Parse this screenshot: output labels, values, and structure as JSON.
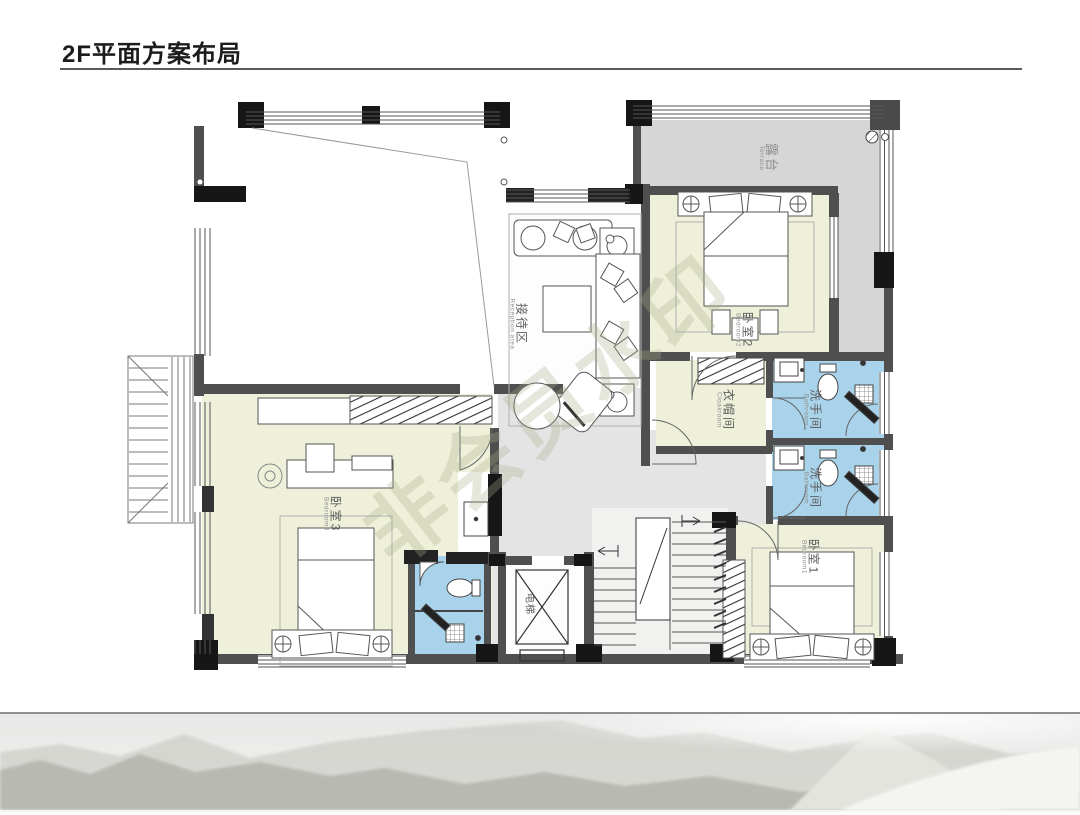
{
  "page": {
    "title": "2F平面方案布局",
    "watermark": "非会员水印"
  },
  "rooms": {
    "terrace": {
      "zh": "露台",
      "en": "Terrace"
    },
    "reception": {
      "zh": "接待区",
      "en": "Reception area"
    },
    "bedroom2": {
      "zh": "卧室2",
      "en": "Bedroom2"
    },
    "cloakroom": {
      "zh": "衣帽间",
      "en": "Cloakroom"
    },
    "bathroom_upper": {
      "zh": "洗手间",
      "en": "Bathroom"
    },
    "bathroom_lower": {
      "zh": "洗手间",
      "en": "Bathroom"
    },
    "bedroom3": {
      "zh": "卧室3",
      "en": "Bedroom3"
    },
    "bedroom1": {
      "zh": "卧室1",
      "en": "Bedroom1"
    },
    "elevator": {
      "zh": "电梯",
      "en": ""
    }
  },
  "colors": {
    "room_fill": "#eff0da",
    "bath_fill": "#a9d3ea",
    "terrace_fill": "#d6d6d6",
    "hall_fill": "#e4e4e5",
    "wall": "#4f4f4f",
    "column": "#161616"
  }
}
